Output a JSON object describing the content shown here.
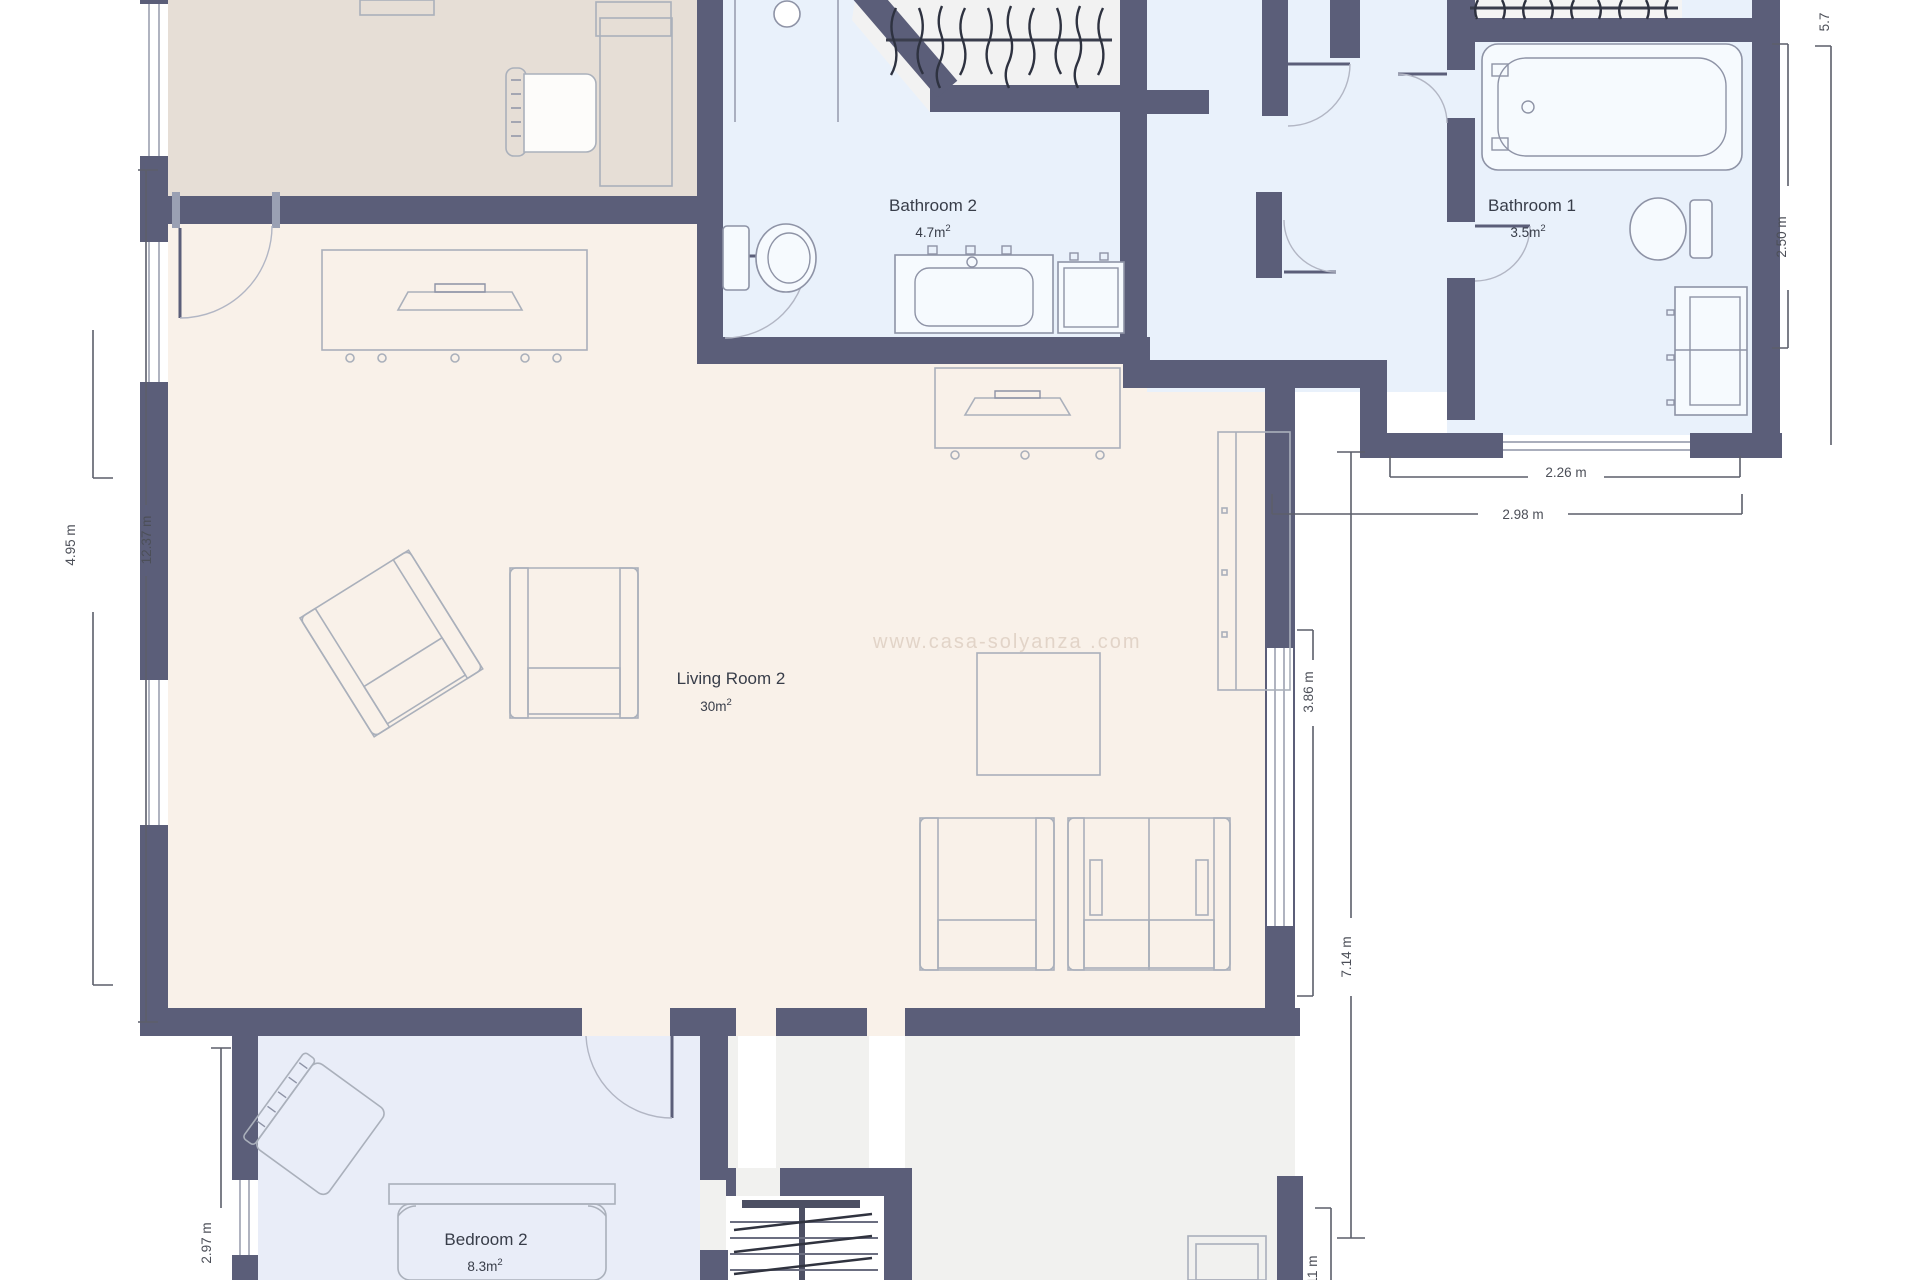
{
  "watermark": "www.casa-solyanza .com",
  "rooms": [
    {
      "name": "Bathroom 2",
      "area": "4.7m",
      "area_sup": "2"
    },
    {
      "name": "Bathroom 1",
      "area": "3.5m",
      "area_sup": "2"
    },
    {
      "name": "Living Room 2",
      "area": "30m",
      "area_sup": "2"
    },
    {
      "name": "Bedroom 2",
      "area": "8.3m",
      "area_sup": "2"
    }
  ],
  "dimensions": {
    "left_inner": "12.37 m",
    "left_outer": "4.95 m",
    "bedroom_left": "2.97 m",
    "bathroom1_right": "2.50 m",
    "top_right_partial": "5.7",
    "bathroom1_bottom": "2.26 m",
    "hallway_bottom": "2.98 m",
    "living_window_right": "3.86 m",
    "living_right_height": "7.14 m",
    "bottom_right_partial": "11 m"
  },
  "colors": {
    "wall": "#5b5e79",
    "office_room_fill": "#e6ded6",
    "living_room_fill": "#f9f1e9",
    "bathroom_fill": "#e9f1fb",
    "bedroom_fill": "#e9edf8",
    "closet_fill": "#f2f2f2",
    "back_room_fill": "#f1f1ef",
    "dimension_text": "#4c4f58",
    "label_text": "#383d49"
  }
}
